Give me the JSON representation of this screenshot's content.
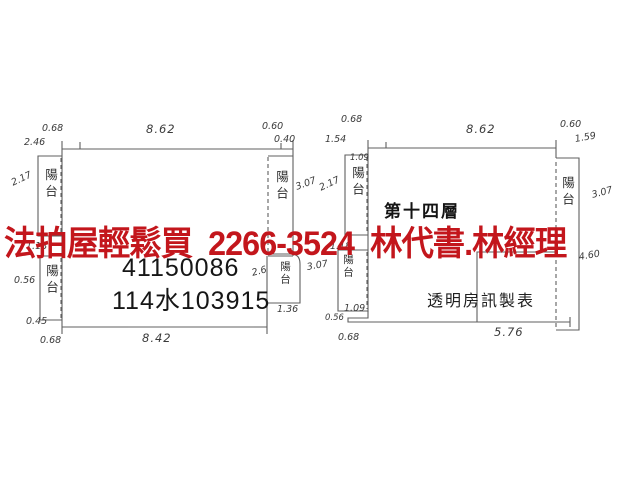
{
  "document": {
    "background": "#ffffff",
    "ink_color": "#4a4a4a"
  },
  "watermark": {
    "text": "法拍屋輕鬆買  2266-3524  林代書.林經理",
    "color": "#c3161c"
  },
  "left_plan": {
    "registration_number": "41150086",
    "meter_number": "114水103915",
    "dim_top": "8.62",
    "dim_bottom": "8.42",
    "balcony_left_upper": "陽台",
    "balcony_left_lower": "陽台",
    "balcony_right_upper": "陽台",
    "balcony_right_lower": "陽台",
    "labels": {
      "top_left_a": "0.68",
      "top_left_b": "2.46",
      "top_right_a": "0.60",
      "top_right_b": "0.40",
      "side_left_a": "2.17",
      "side_left_b": "1.18",
      "side_left_c": "0.56",
      "bottom_left_a": "0.45",
      "bottom_left_b": "0.68",
      "side_right_a": "3.07",
      "side_right_b": "2.6",
      "side_right_c": "3.07",
      "balcony_small": "1.36"
    }
  },
  "right_plan": {
    "floor_label": "第十四層",
    "publisher_label": "透明房訊製表",
    "dim_top": "8.62",
    "dim_bottom": "5.76",
    "balcony_left_upper": "陽台",
    "balcony_left_lower": "陽台",
    "balcony_right": "陽台",
    "labels": {
      "top_left_a": "0.68",
      "top_left_b": "1.54",
      "top_right_a": "0.60",
      "top_right_b": "1.59",
      "side_left_a": "2.17",
      "balcony_top": "1.09",
      "side_left_b": "1.18",
      "side_left_c": "1.09",
      "bottom_left_a": "0.56",
      "bottom_left_b": "0.68",
      "side_right_a": "3.07",
      "side_right_b": "4.60"
    }
  }
}
